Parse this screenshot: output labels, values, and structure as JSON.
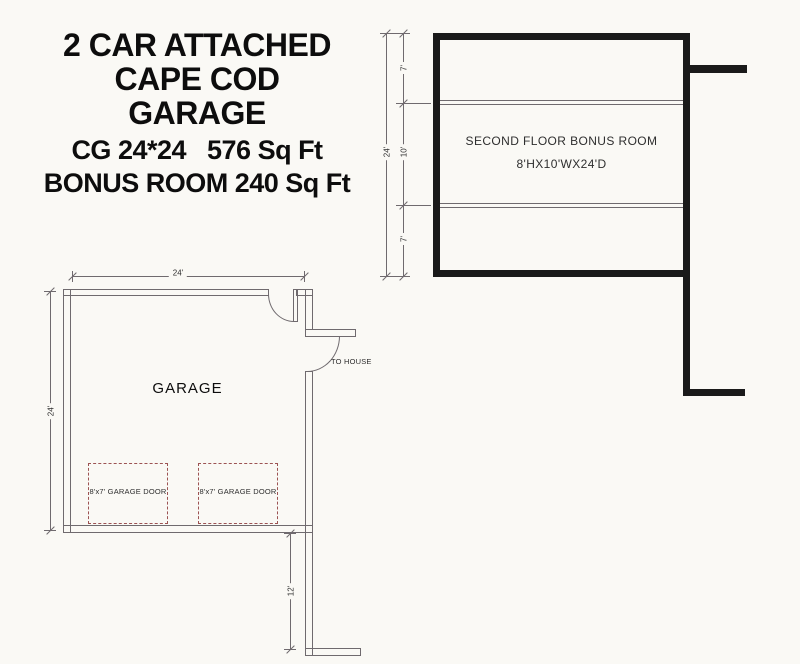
{
  "colors": {
    "background": "#faf9f5",
    "wall": "#1a1a1a",
    "line": "#6f6a6e",
    "dash": "#9c5353",
    "heading": "#0d0d0d",
    "label": "#2e2e2e"
  },
  "title_block": {
    "heading_line_1": "2 CAR ATTACHED",
    "heading_line_2": "CAPE COD",
    "heading_line_3": "GARAGE",
    "spec_line_1": "CG 24*24   576 Sq Ft",
    "spec_line_2": "BONUS ROOM 240 Sq Ft"
  },
  "bonus_room_plan": {
    "name_line_1": "SECOND FLOOR BONUS ROOM",
    "name_line_2": "8'HX10'WX24'D",
    "dim_overall": "24'",
    "dim_segment_top": "7'",
    "dim_segment_middle": "10'",
    "dim_segment_bottom": "7'"
  },
  "garage_plan": {
    "name": "GARAGE",
    "to_house": "TO HOUSE",
    "garage_door_left": "8'x7' GARAGE DOOR",
    "garage_door_right": "8'x7' GARAGE DOOR",
    "dim_width": "24'",
    "dim_depth": "24'",
    "dim_driveway": "12'"
  }
}
